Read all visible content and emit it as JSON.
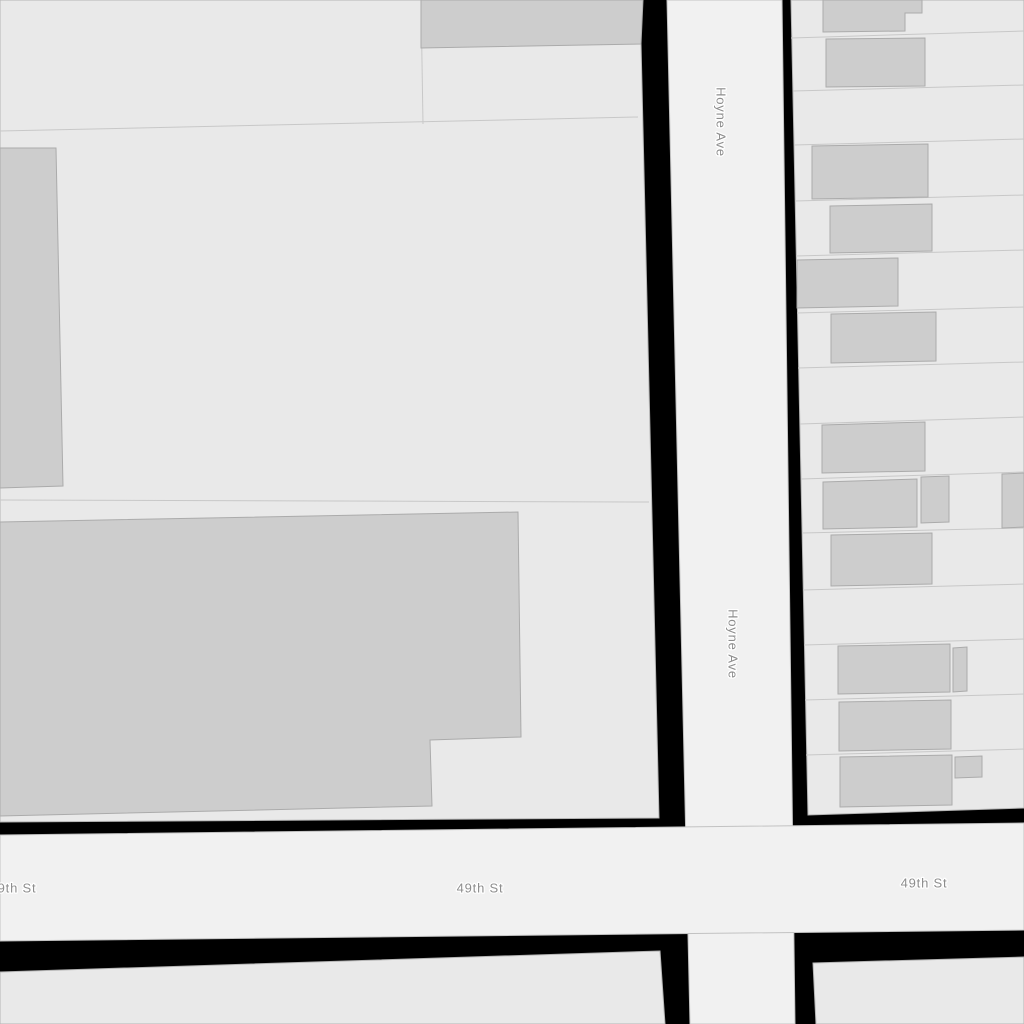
{
  "map": {
    "canvas": {
      "width": 1024,
      "height": 1024
    },
    "colors": {
      "background": "#000000",
      "street_fill": "#f1f1f1",
      "street_stroke": "#c2c2c2",
      "block_fill": "#e9e9e9",
      "block_stroke": "#b5b5b5",
      "lot_line": "#c8c8c8",
      "building_fill": "#cdcdcd",
      "building_stroke": "#ababab",
      "label_color": "#8d8d8d",
      "label_halo": "#ffffff"
    },
    "streets": [
      {
        "name": "Hoyne Ave",
        "points": "667,0 782,0 795,1024 690,1024"
      },
      {
        "name": "49th St",
        "points": "0,835 1024,823 1024,930 0,941"
      }
    ],
    "blocks": [
      {
        "id": "block-northwest",
        "points": "0,0 640,0 659,818 0,822"
      },
      {
        "id": "block-northeast",
        "points": "791,0 1024,0 1024,808 808,815"
      },
      {
        "id": "block-southwest",
        "points": "0,972 660,951 665,1024 0,1024"
      },
      {
        "id": "block-southeast",
        "points": "813,963 1024,957 1024,1024 816,1024"
      }
    ],
    "lot_lines": [
      {
        "x1": 0,
        "y1": 131,
        "x2": 638,
        "y2": 117
      },
      {
        "x1": 421,
        "y1": 0,
        "x2": 423,
        "y2": 124
      },
      {
        "x1": 0,
        "y1": 500,
        "x2": 649,
        "y2": 502
      },
      {
        "x1": 791,
        "y1": 38,
        "x2": 1024,
        "y2": 31
      },
      {
        "x1": 793,
        "y1": 91,
        "x2": 1024,
        "y2": 85
      },
      {
        "x1": 794,
        "y1": 145,
        "x2": 1024,
        "y2": 139
      },
      {
        "x1": 795,
        "y1": 201,
        "x2": 1024,
        "y2": 195
      },
      {
        "x1": 796,
        "y1": 256,
        "x2": 1024,
        "y2": 250
      },
      {
        "x1": 797,
        "y1": 313,
        "x2": 1024,
        "y2": 307
      },
      {
        "x1": 798,
        "y1": 368,
        "x2": 1024,
        "y2": 362
      },
      {
        "x1": 800,
        "y1": 424,
        "x2": 1024,
        "y2": 417
      },
      {
        "x1": 801,
        "y1": 479,
        "x2": 1024,
        "y2": 472
      },
      {
        "x1": 802,
        "y1": 533,
        "x2": 1024,
        "y2": 528
      },
      {
        "x1": 803,
        "y1": 590,
        "x2": 1024,
        "y2": 584
      },
      {
        "x1": 804,
        "y1": 645,
        "x2": 1024,
        "y2": 639
      },
      {
        "x1": 805,
        "y1": 700,
        "x2": 1024,
        "y2": 694
      },
      {
        "x1": 806,
        "y1": 755,
        "x2": 1024,
        "y2": 749
      }
    ],
    "buildings": [
      {
        "id": "building-nw-top",
        "points": "421,0 643,0 641,44 421,48"
      },
      {
        "id": "building-nw-tall",
        "points": "0,148 56,148 63,486 0,488"
      },
      {
        "id": "building-nw-large",
        "points": "0,522 518,512 521,737 430,740 432,806 0,816"
      },
      {
        "id": "building-ne-1",
        "points": "823,0 922,0 922,13 905,13 905,31 823,32"
      },
      {
        "id": "building-ne-2",
        "points": "826,39 925,38 925,86 826,87"
      },
      {
        "id": "building-ne-3",
        "points": "812,146 928,144 928,197 812,199"
      },
      {
        "id": "building-ne-4",
        "points": "830,206 932,204 932,251 830,253"
      },
      {
        "id": "building-ne-5",
        "points": "797,260 898,258 898,306 797,308"
      },
      {
        "id": "building-ne-6",
        "points": "831,314 936,312 936,361 831,363"
      },
      {
        "id": "building-ne-7",
        "points": "822,425 925,422 925,471 822,473"
      },
      {
        "id": "building-ne-8",
        "points": "823,482 917,479 917,527 823,529"
      },
      {
        "id": "building-ne-8b",
        "points": "921,477 949,476 949,522 921,523"
      },
      {
        "id": "building-ne-8c",
        "points": "1002,474 1024,473 1024,527 1002,528"
      },
      {
        "id": "building-ne-9",
        "points": "831,535 932,533 932,584 831,586"
      },
      {
        "id": "building-ne-10",
        "points": "838,646 950,644 950,692 838,694"
      },
      {
        "id": "building-ne-10b",
        "points": "953,648 967,647 967,691 953,692"
      },
      {
        "id": "building-ne-11",
        "points": "839,702 951,700 951,749 839,751"
      },
      {
        "id": "building-ne-12",
        "points": "840,757 952,755 952,805 840,807"
      },
      {
        "id": "building-ne-12b",
        "points": "955,757 982,756 982,777 955,778"
      }
    ],
    "labels": [
      {
        "text": "Hoyne Ave",
        "x": 721,
        "y": 122,
        "rotate": 90
      },
      {
        "text": "Hoyne Ave",
        "x": 733,
        "y": 644,
        "rotate": 90
      },
      {
        "text": "49th St",
        "x": 13,
        "y": 888,
        "rotate": 0
      },
      {
        "text": "49th St",
        "x": 480,
        "y": 888,
        "rotate": 0
      },
      {
        "text": "49th St",
        "x": 924,
        "y": 883,
        "rotate": 0
      }
    ]
  }
}
